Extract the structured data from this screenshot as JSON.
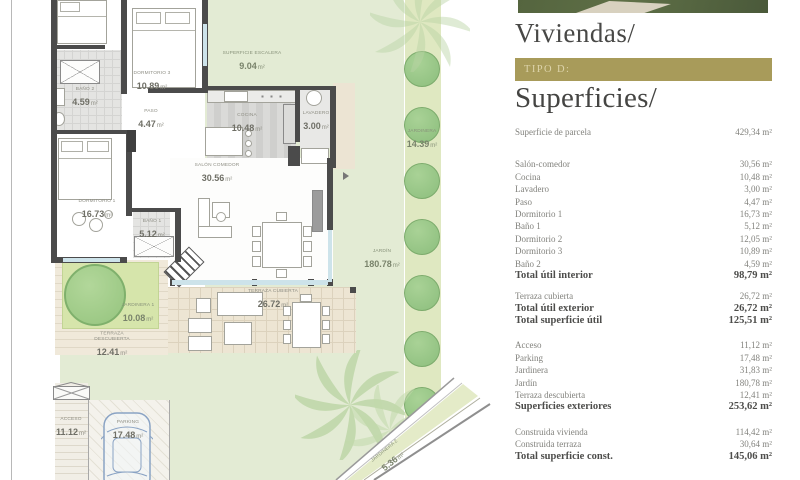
{
  "plan": {
    "unit": "m²",
    "labels": [
      {
        "name": "DORMITORIO 3",
        "area": "10.89"
      },
      {
        "name": "BAÑO 2",
        "area": "4.59"
      },
      {
        "name": "PASO",
        "area": "4.47"
      },
      {
        "name": "COCINA",
        "area": "10.48"
      },
      {
        "name": "LAVADERO",
        "area": "3.00"
      },
      {
        "name": "DORMITORIO 1",
        "area": "16.73"
      },
      {
        "name": "BAÑO 1",
        "area": "5.12"
      },
      {
        "name": "SALÓN COMEDOR",
        "area": "30.56"
      },
      {
        "name": "SUPERFICIE ESCALERA",
        "area": "9.04"
      },
      {
        "name": "JARDINERA",
        "area": "14.39"
      },
      {
        "name": "JARDÍN",
        "area": "180.78"
      },
      {
        "name": "JARDINERA 1",
        "area": "10.08"
      },
      {
        "name": "TERRAZA DESCUBIERTA",
        "area": "12.41"
      },
      {
        "name": "TERRAZA CUBIERTA",
        "area": "26.72"
      },
      {
        "name": "ACCESO",
        "area": "11.12"
      },
      {
        "name": "PARKING",
        "area": "17.48"
      },
      {
        "name": "JARDINERA 2",
        "area": "5.36"
      }
    ]
  },
  "panel": {
    "title": "Viviendas/",
    "badge": "TIPO D:",
    "subtitle": "Superficies/",
    "accent_color": "#a89b5a",
    "groups": [
      {
        "rows": [
          {
            "label": "Superficie de parcela",
            "value": "429,34 m²"
          }
        ]
      },
      {
        "rows": [
          {
            "label": "Salón-comedor",
            "value": "30,56 m²"
          },
          {
            "label": "Cocina",
            "value": "10,48 m²"
          },
          {
            "label": "Lavadero",
            "value": "3,00 m²"
          },
          {
            "label": "Paso",
            "value": "4,47 m²"
          },
          {
            "label": "Dormitorio 1",
            "value": "16,73 m²"
          },
          {
            "label": "Baño 1",
            "value": "5,12 m²"
          },
          {
            "label": "Dormitorio 2",
            "value": "12,05 m²"
          },
          {
            "label": "Dormitorio 3",
            "value": "10,89 m²"
          },
          {
            "label": "Baño 2",
            "value": "4,59 m²"
          },
          {
            "label": "Total útil interior",
            "value": "98,79 m²",
            "total": true
          }
        ]
      },
      {
        "rows": [
          {
            "label": "Terraza cubierta",
            "value": "26,72 m²"
          },
          {
            "label": "Total útil exterior",
            "value": "26,72 m²",
            "total": true
          },
          {
            "label": "Total superficie útil",
            "value": "125,51 m²",
            "total": true
          }
        ]
      },
      {
        "rows": [
          {
            "label": "Acceso",
            "value": "11,12 m²"
          },
          {
            "label": "Parking",
            "value": "17,48 m²"
          },
          {
            "label": "Jardinera",
            "value": "31,83 m²"
          },
          {
            "label": "Jardín",
            "value": "180,78 m²"
          },
          {
            "label": "Terraza descubierta",
            "value": "12,41 m²"
          },
          {
            "label": "Superficies exteriores",
            "value": "253,62 m²",
            "total": true
          }
        ]
      },
      {
        "rows": [
          {
            "label": "Construida vivienda",
            "value": "114,42 m²"
          },
          {
            "label": "Construida terraza",
            "value": "30,64 m²"
          },
          {
            "label": "Total superficie const.",
            "value": "145,06 m²",
            "total": true
          }
        ]
      }
    ]
  }
}
